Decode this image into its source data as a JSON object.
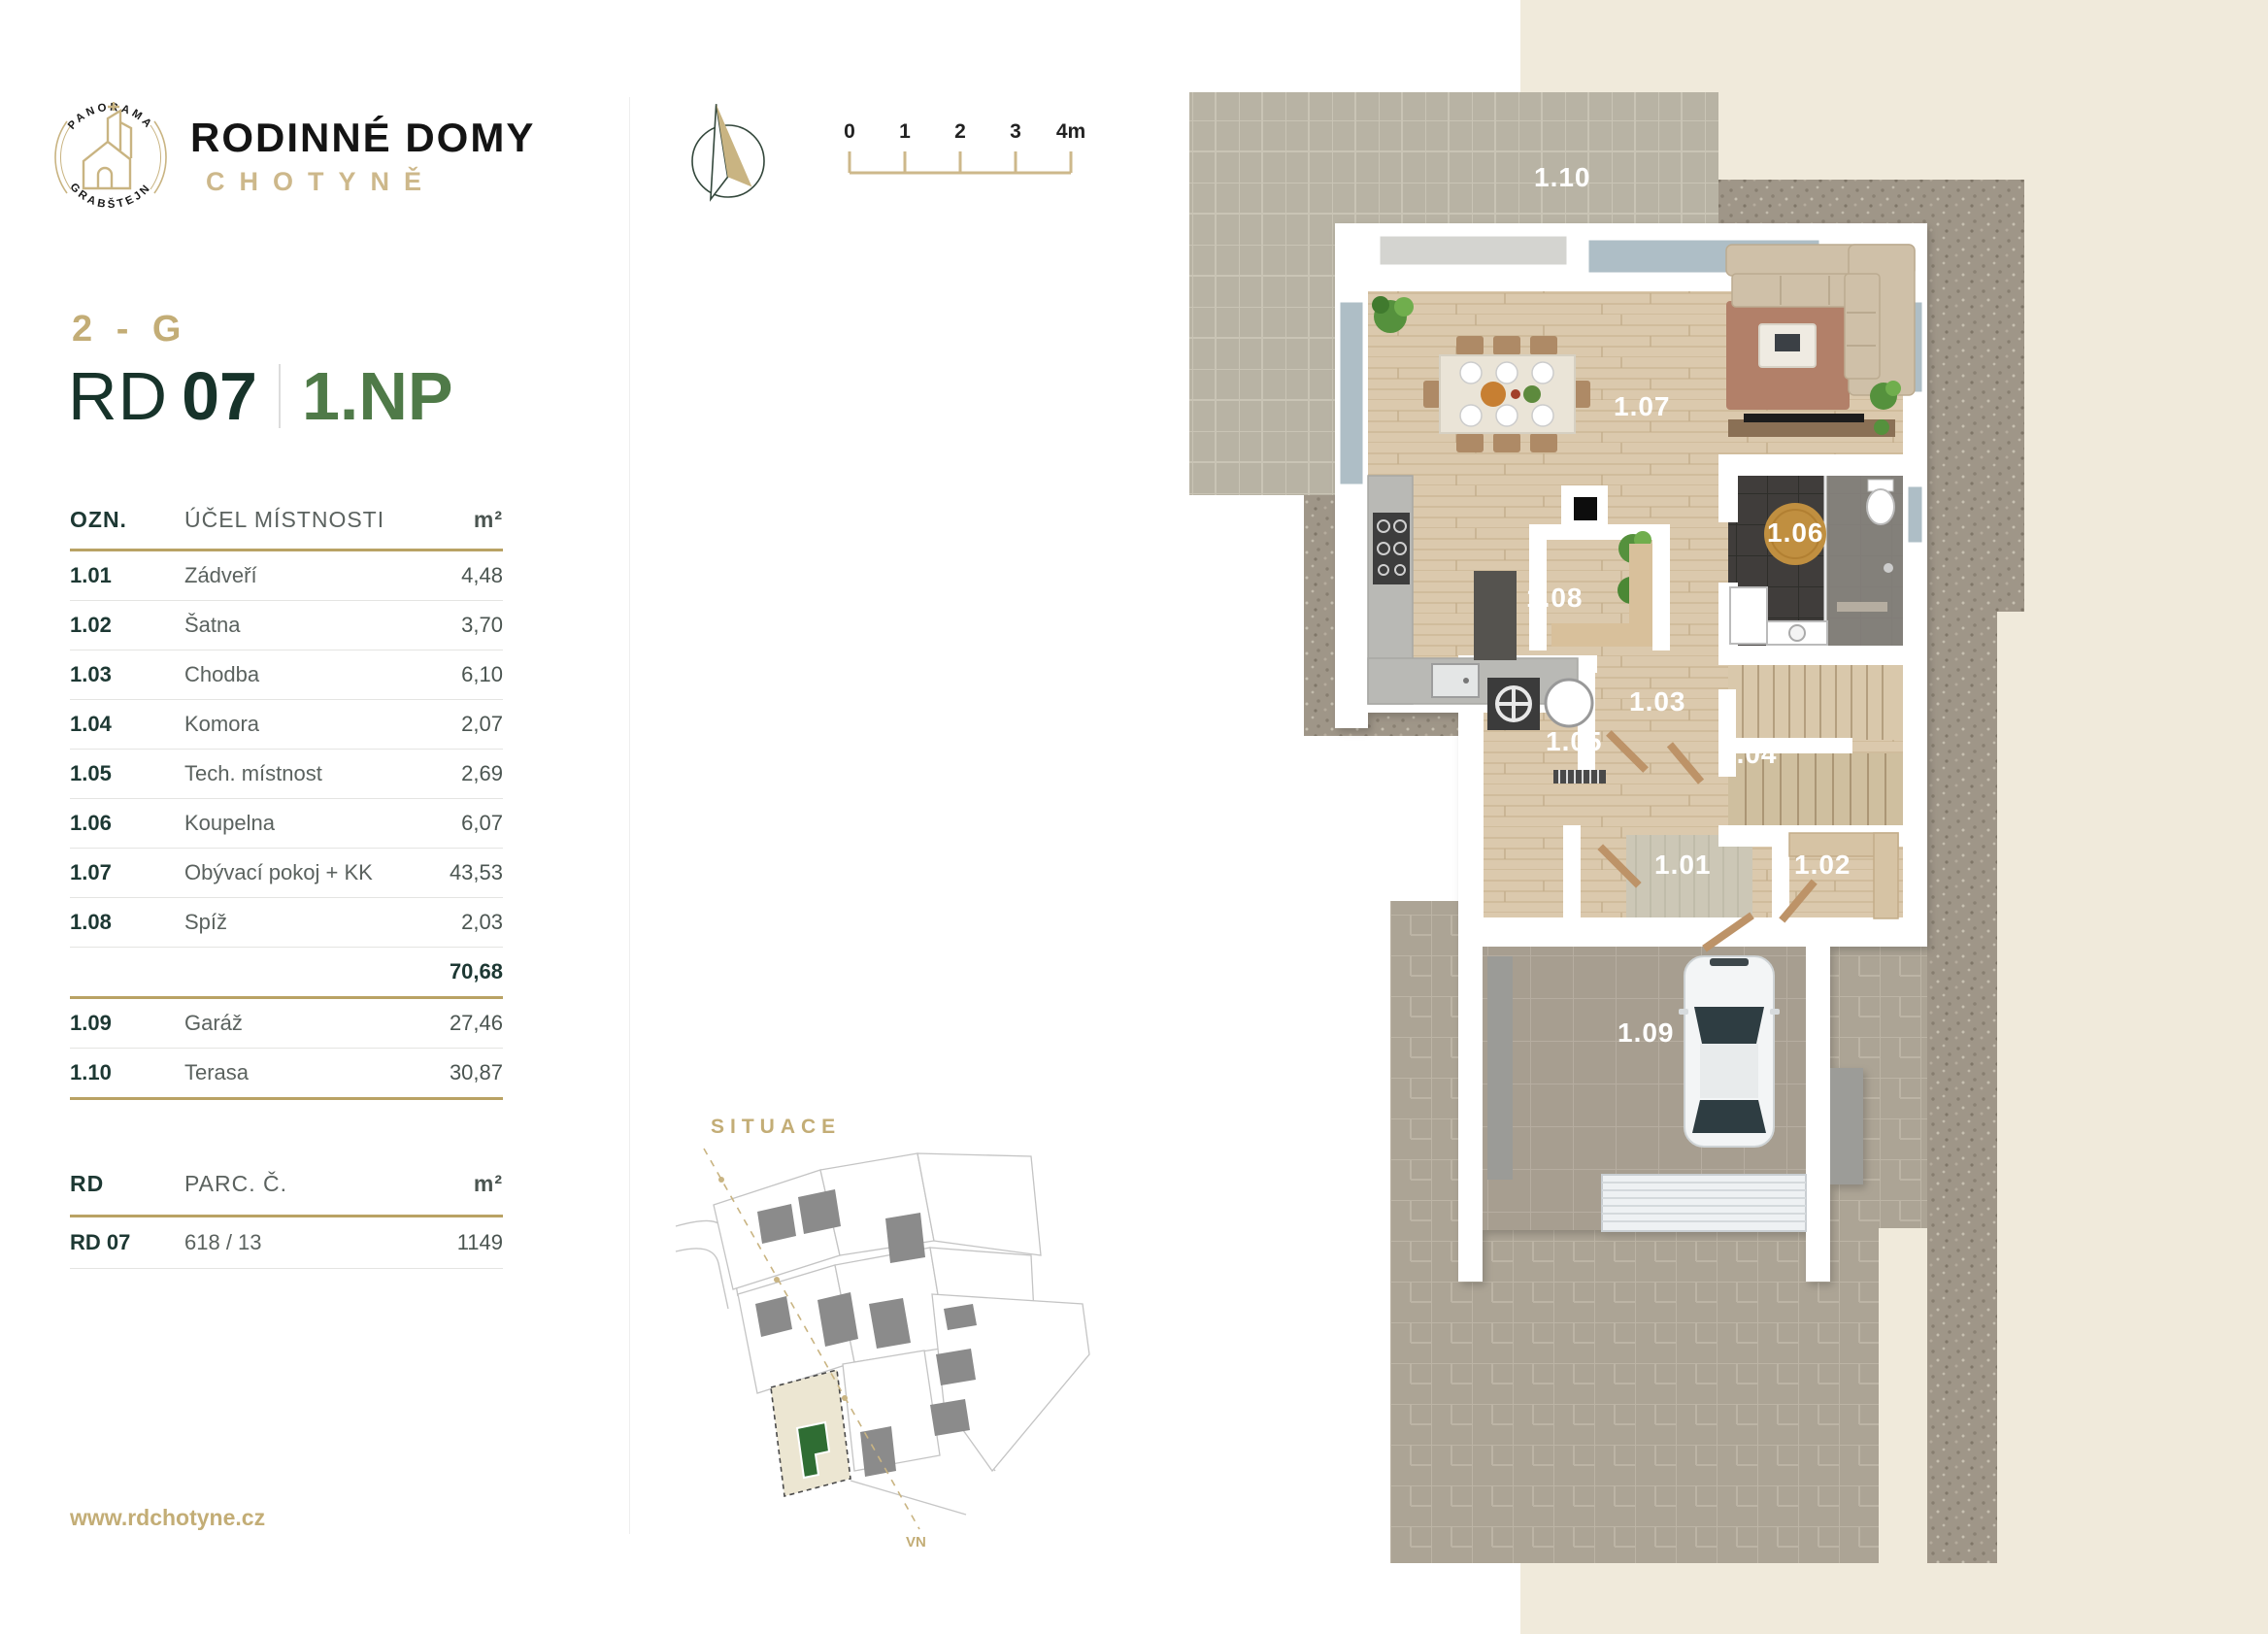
{
  "brand": {
    "logo_arc_top": "PANORAMA",
    "logo_arc_bottom": "GRABŠTEJN",
    "title": "RODINNÉ DOMY",
    "subtitle": "CHOTYNĚ"
  },
  "header": {
    "variant": "2 - G",
    "house_code": "RD",
    "house_number": "07",
    "floor": "1.NP"
  },
  "room_table": {
    "col_ozn": "OZN.",
    "col_name": "ÚČEL MÍSTNOSTI",
    "col_area": "m²",
    "rows": [
      {
        "ozn": "1.01",
        "name": "Zádveří",
        "area": "4,48"
      },
      {
        "ozn": "1.02",
        "name": "Šatna",
        "area": "3,70"
      },
      {
        "ozn": "1.03",
        "name": "Chodba",
        "area": "6,10"
      },
      {
        "ozn": "1.04",
        "name": "Komora",
        "area": "2,07"
      },
      {
        "ozn": "1.05",
        "name": "Tech. místnost",
        "area": "2,69"
      },
      {
        "ozn": "1.06",
        "name": "Koupelna",
        "area": "6,07"
      },
      {
        "ozn": "1.07",
        "name": "Obývací pokoj + KK",
        "area": "43,53"
      },
      {
        "ozn": "1.08",
        "name": "Spíž",
        "area": "2,03"
      }
    ],
    "subtotal": "70,68",
    "extra_rows": [
      {
        "ozn": "1.09",
        "name": "Garáž",
        "area": "27,46"
      },
      {
        "ozn": "1.10",
        "name": "Terasa",
        "area": "30,87"
      }
    ]
  },
  "parcel_table": {
    "col_rd": "RD",
    "col_parc": "PARC. Č.",
    "col_area": "m²",
    "row": {
      "rd": "RD 07",
      "parc": "618 / 13",
      "area": "1149"
    }
  },
  "scalebar": {
    "ticks": [
      "0",
      "1",
      "2",
      "3",
      "4m"
    ]
  },
  "situace": {
    "label": "SITUACE",
    "line_label": "VN"
  },
  "plan": {
    "labels": [
      {
        "id": "1.10"
      },
      {
        "id": "1.07"
      },
      {
        "id": "1.08"
      },
      {
        "id": "1.06"
      },
      {
        "id": "1.03"
      },
      {
        "id": "1.05"
      },
      {
        "id": "1.04"
      },
      {
        "id": "1.01"
      },
      {
        "id": "1.02"
      },
      {
        "id": "1.09"
      }
    ]
  },
  "footer": {
    "website": "www.rdchotyne.cz"
  },
  "colors": {
    "gold": "#b9a264",
    "gold_light": "#cdb88b",
    "green_dark": "#17332a",
    "green": "#4f7a48",
    "cream": "#f0eadb",
    "selected_house_green": "#2f6d33"
  }
}
